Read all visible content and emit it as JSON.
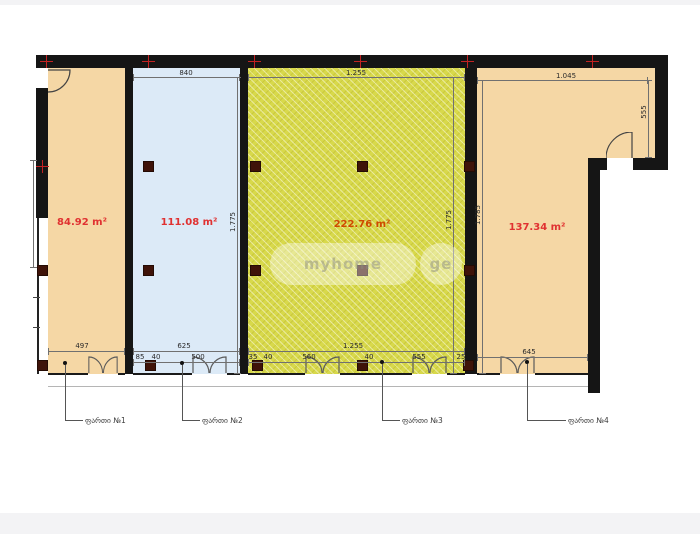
{
  "floorplan": {
    "units": [
      {
        "area": "84.92 m²",
        "label": "ფართი №1"
      },
      {
        "area": "111.08 m²",
        "label": "ფართი №2"
      },
      {
        "area": "222.76 m²",
        "label": "ფართი №3"
      },
      {
        "area": "137.34 m²",
        "label": "ფართი №4"
      }
    ],
    "dims": {
      "top": [
        "840",
        "1.255",
        "1.045"
      ],
      "rowA": [
        "497",
        "625",
        "1.255",
        "645"
      ],
      "s2b": [
        "85",
        "40",
        "500"
      ],
      "s3b": [
        "35",
        "40",
        "560",
        "40",
        "555",
        "25"
      ],
      "vert": [
        "1.775",
        "1.775",
        "1.785",
        "555"
      ]
    },
    "watermark": {
      "brand": "myhome",
      "tld": "ge"
    },
    "colors": {
      "unit1_fill": "#f5d7a5",
      "unit2_fill": "#dceaf7",
      "unit3_fill": "#d8d94b",
      "unit4_fill": "#f5d7a5",
      "wall": "#151515",
      "column": "#3f1309",
      "grid_marker": "#c22222",
      "area_text": "#e03131",
      "area_text_unit3": "#cf4a00"
    }
  }
}
